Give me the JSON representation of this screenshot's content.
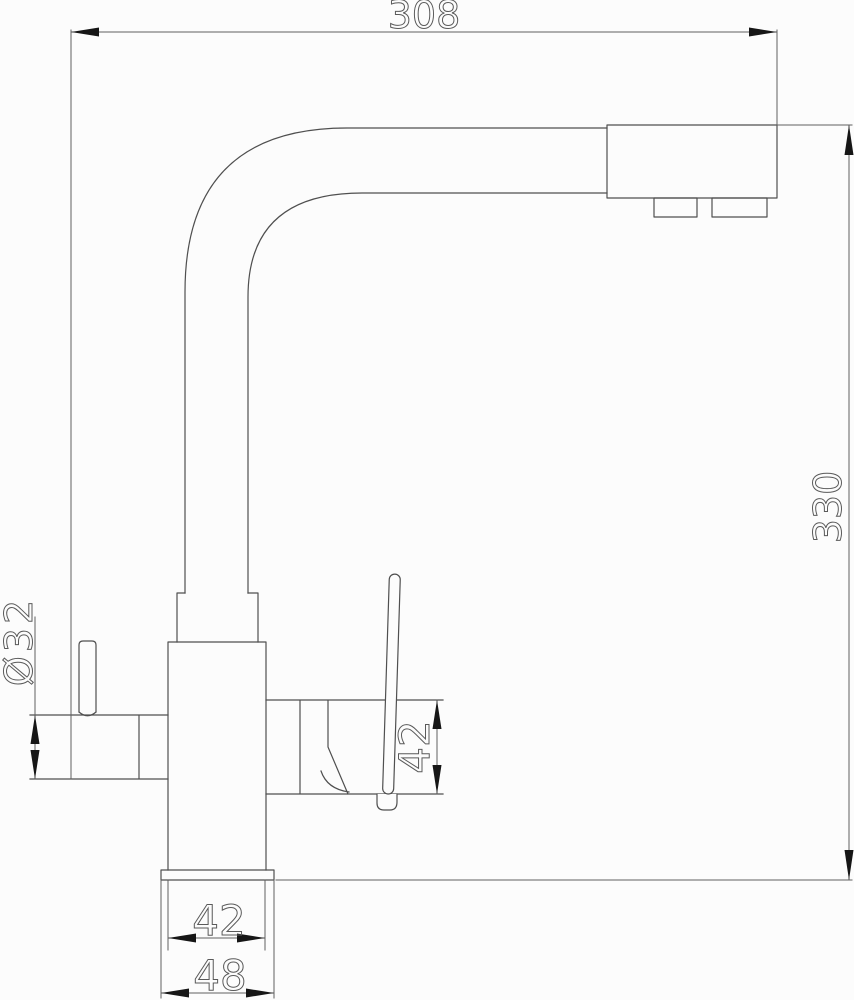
{
  "colors": {
    "outline": "#4f4f4f",
    "dimension": "#5f5f5f",
    "arrow": "#161616",
    "label": "#5a5a5a",
    "background": "#fcfcfc"
  },
  "labels": {
    "width_overall": "308",
    "height_overall": "330",
    "spout_diameter": "Ø32",
    "handle_height": "42",
    "body_width": "42",
    "base_width": "48"
  }
}
